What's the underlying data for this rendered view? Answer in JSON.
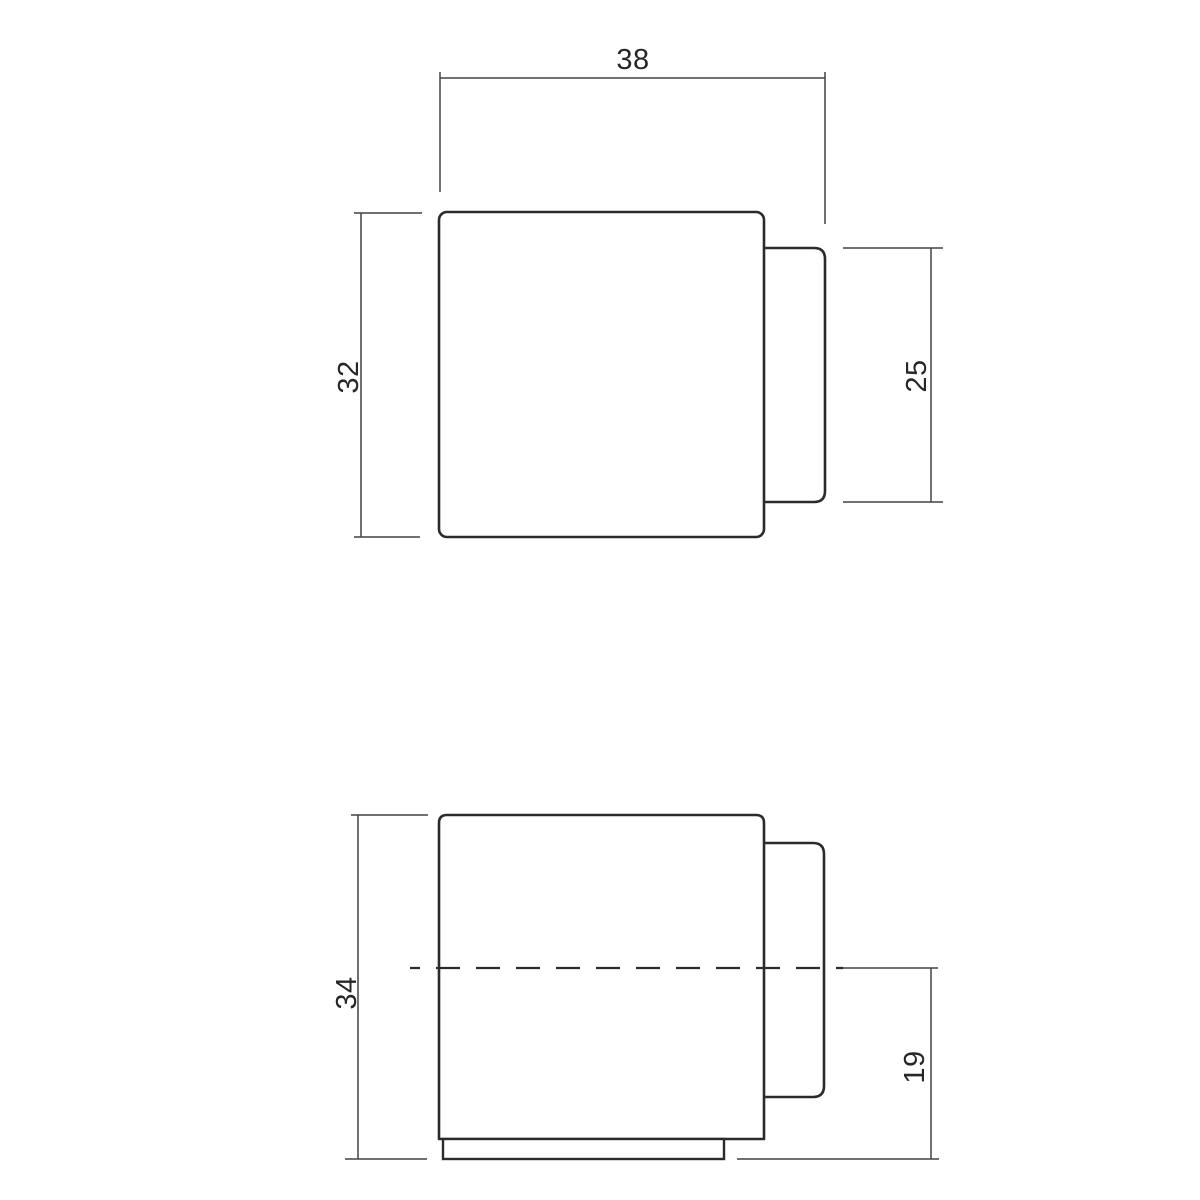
{
  "drawing": {
    "kind": "technical-drawing",
    "views": [
      "top-view",
      "front-view"
    ],
    "background_color": "#ffffff",
    "object_line_color": "#2b2b2b",
    "dimension_line_color": "#424242",
    "text_color": "#272727"
  },
  "dimensions": {
    "top_width": "38",
    "top_height": "32",
    "top_bumper_height": "25",
    "front_height": "34",
    "front_bumper_offset": "19"
  }
}
